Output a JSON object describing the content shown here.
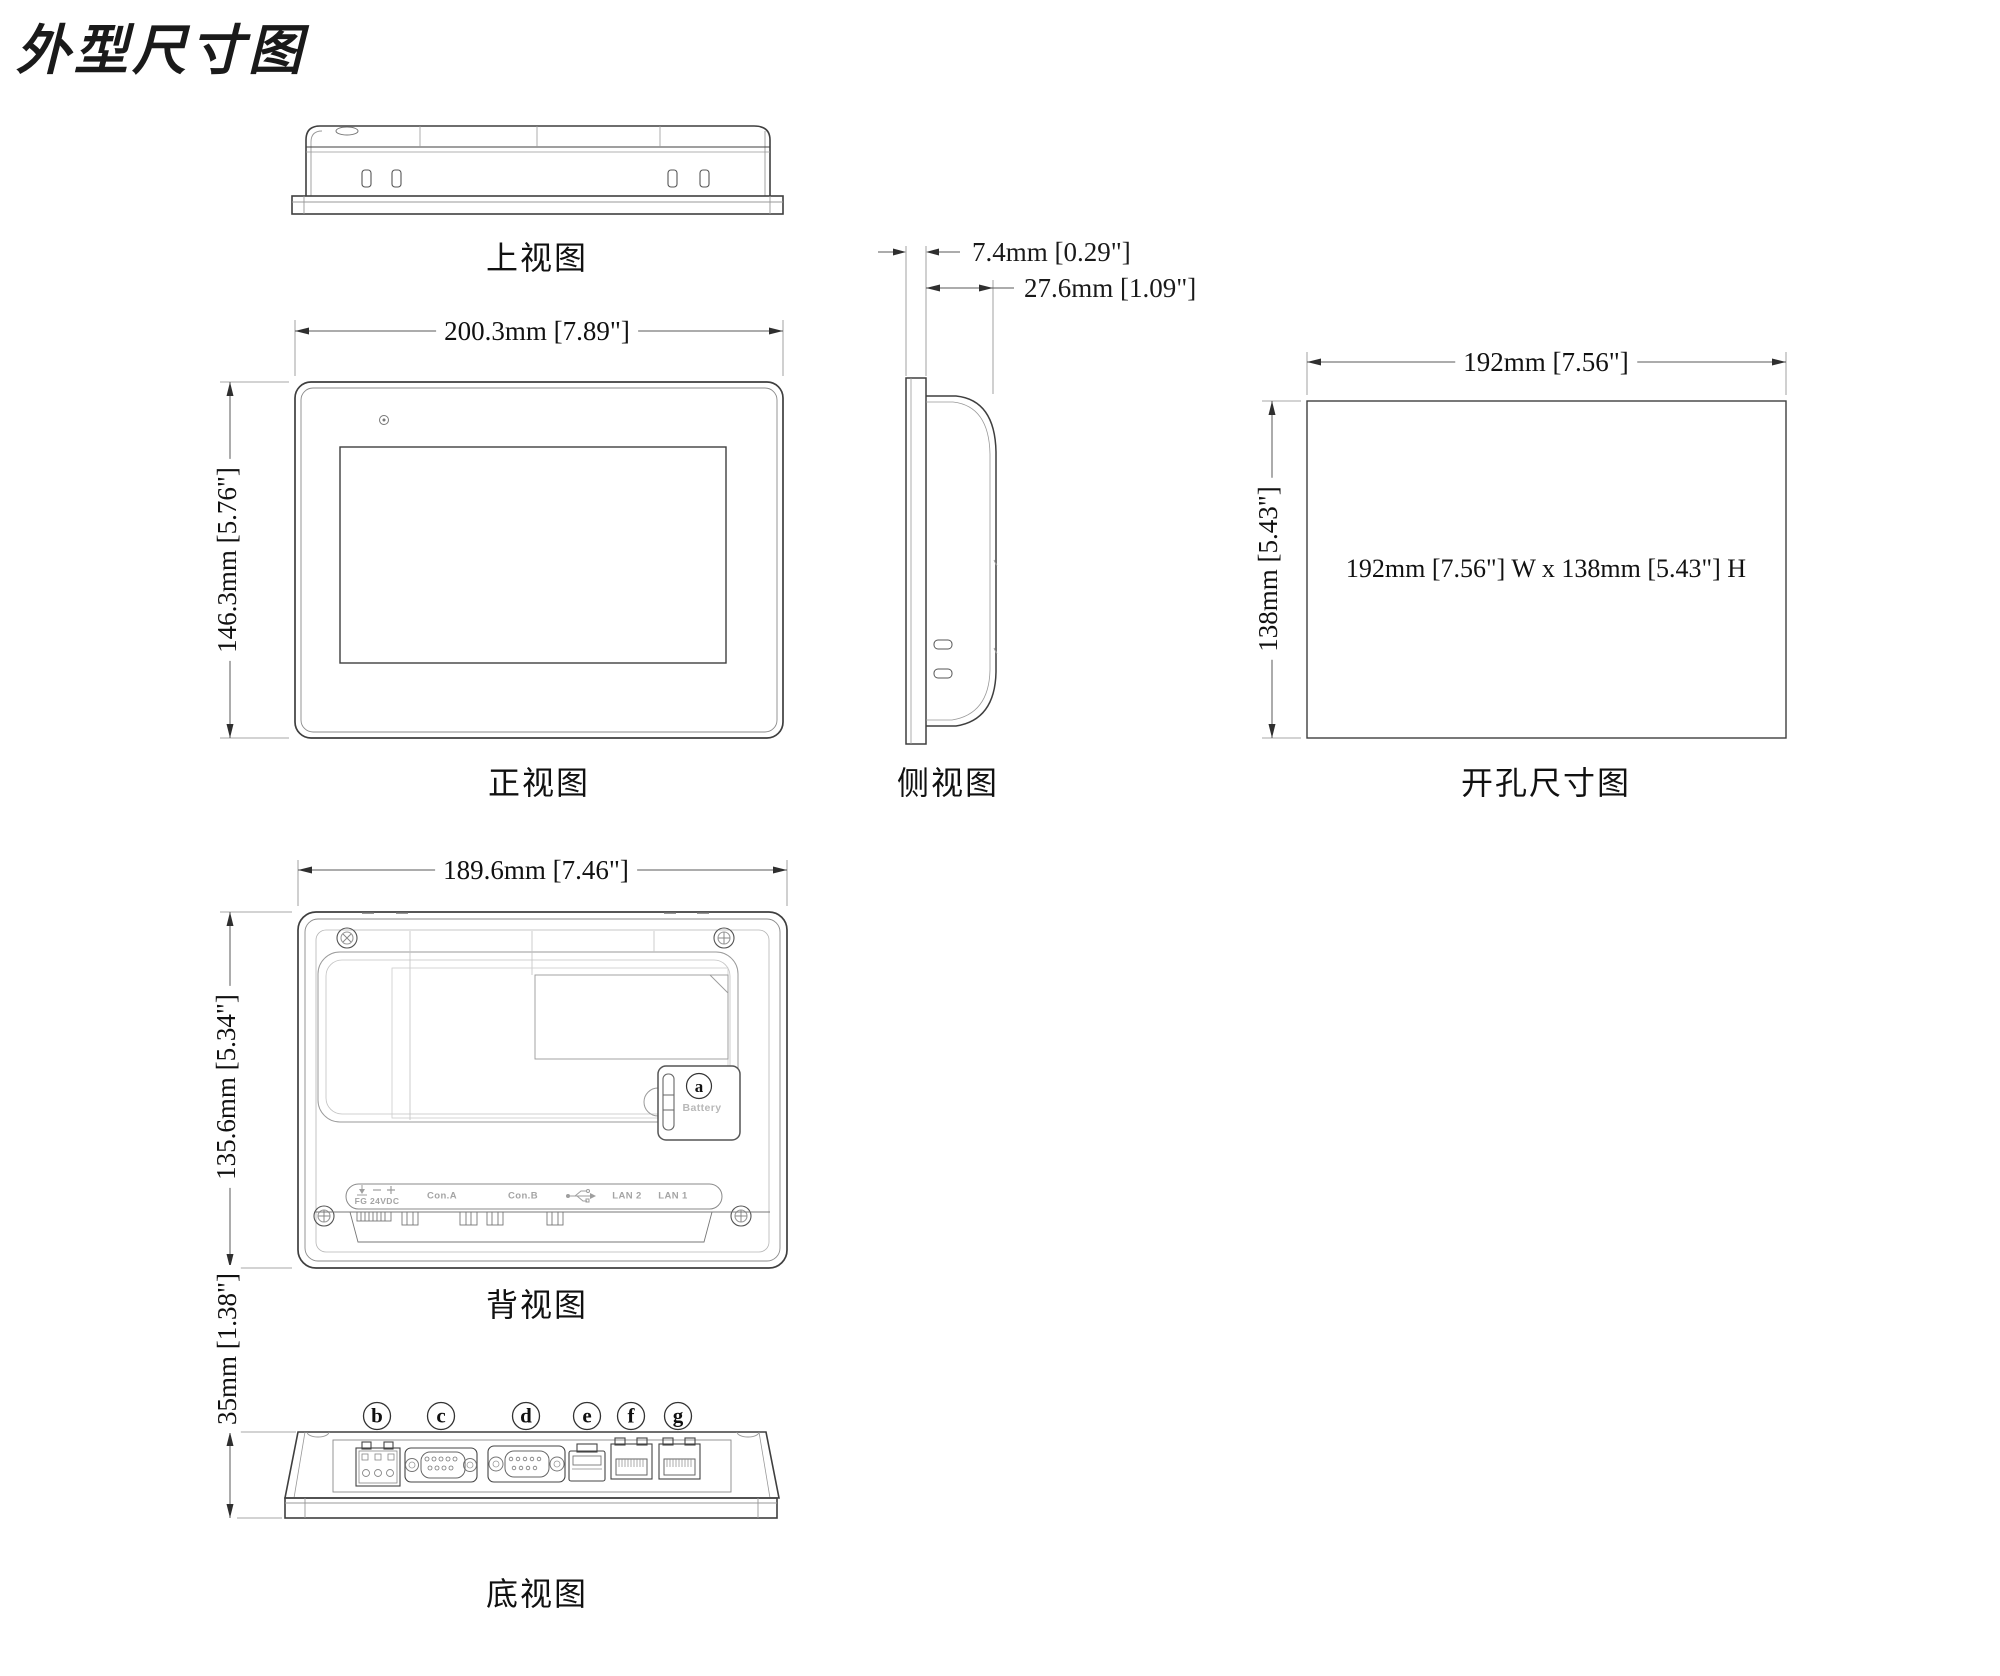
{
  "title": "外型尺寸图",
  "colors": {
    "line": "#3f3f3f",
    "dim_line": "#5a5a5a",
    "engraved_text": "#a4a4a4"
  },
  "icons": {
    "usb": "usb-icon",
    "ground": "ground-icon",
    "minus": "minus-icon",
    "plus": "plus-icon",
    "screw": "screw-icon",
    "led": "led-icon"
  },
  "views": {
    "top": {
      "label": "上视图"
    },
    "front": {
      "label": "正视图",
      "width_dim": "200.3mm [7.89\"]",
      "height_dim": "146.3mm [5.76\"]"
    },
    "side": {
      "label": "侧视图",
      "bezel_depth_dim": "7.4mm [0.29\"]",
      "body_depth_dim": "27.6mm [1.09\"]"
    },
    "cutout": {
      "label": "开孔尺寸图",
      "width_dim": "192mm [7.56\"]",
      "height_dim": "138mm [5.43\"]",
      "note": "192mm [7.56\"] W x 138mm [5.43\"] H"
    },
    "back": {
      "label": "背视图",
      "width_dim": "189.6mm [7.46\"]",
      "height_dim": "135.6mm [5.34\"]",
      "battery_marker": "a",
      "battery_label": "Battery",
      "ports": {
        "power": "FG 24VDC",
        "com_a": "Con.A",
        "com_b": "Con.B",
        "lan2": "LAN 2",
        "lan1": "LAN 1"
      }
    },
    "bottom": {
      "label": "底视图",
      "height_dim": "35mm [1.38\"]",
      "markers": [
        "b",
        "c",
        "d",
        "e",
        "f",
        "g"
      ]
    }
  }
}
